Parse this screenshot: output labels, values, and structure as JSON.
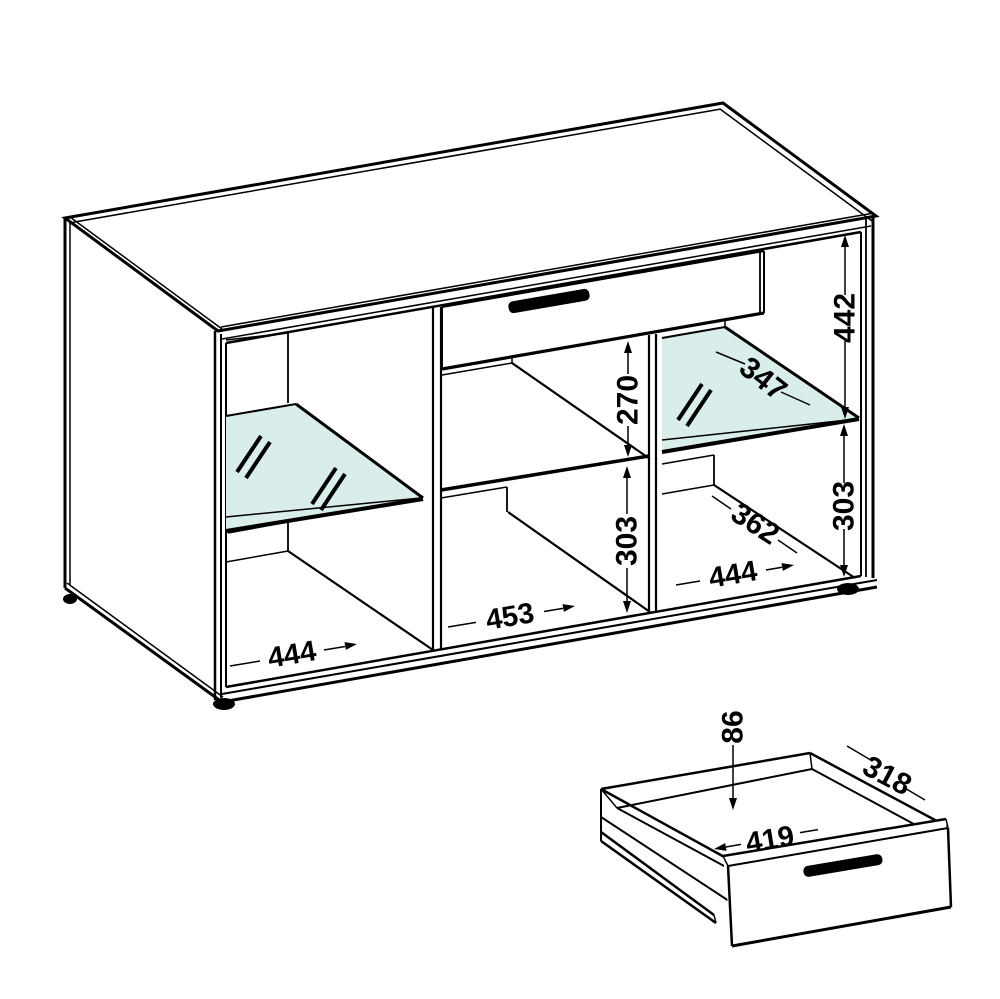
{
  "diagram": {
    "type": "furniture-assembly-dimension-drawing",
    "colors": {
      "line": "#000000",
      "glass_fill": "#d9eeeb",
      "background": "#ffffff"
    },
    "cabinet": {
      "dims": {
        "right_upper_inner_height": "442",
        "glass_shelf_depth": "347",
        "middle_upper_inner_height": "270",
        "middle_lower_inner_height": "303",
        "right_lower_inner_height": "303",
        "right_lower_depth": "362",
        "left_cell_width": "444",
        "middle_cell_width": "453",
        "right_cell_width": "444"
      }
    },
    "drawer_detail": {
      "dims": {
        "inner_height": "86",
        "side_depth": "318",
        "inner_width": "419"
      }
    }
  }
}
